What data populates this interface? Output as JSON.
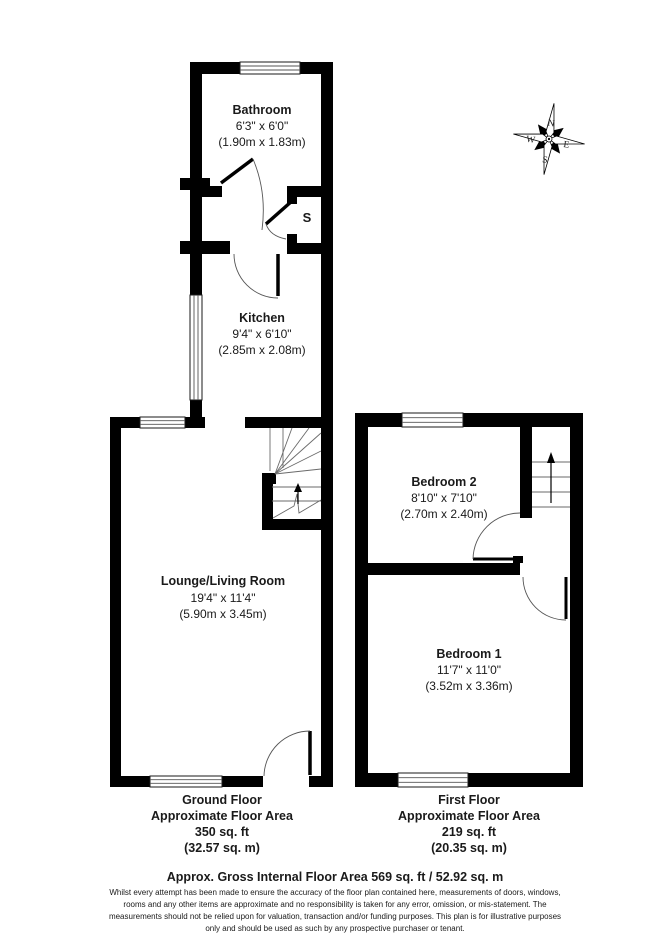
{
  "compass": {
    "n": "N",
    "e": "E",
    "s": "S",
    "w": "W"
  },
  "rooms": {
    "bathroom": {
      "name": "Bathroom",
      "size_imperial": "6'3\" x 6'0\"",
      "size_metric": "(1.90m x 1.83m)"
    },
    "kitchen": {
      "name": "Kitchen",
      "size_imperial": "9'4\" x 6'10\"",
      "size_metric": "(2.85m x 2.08m)"
    },
    "lounge": {
      "name": "Lounge/Living Room",
      "size_imperial": "19'4\" x 11'4\"",
      "size_metric": "(5.90m x 3.45m)"
    },
    "bedroom2": {
      "name": "Bedroom 2",
      "size_imperial": "8'10\" x 7'10\"",
      "size_metric": "(2.70m x 2.40m)"
    },
    "bedroom1": {
      "name": "Bedroom 1",
      "size_imperial": "11'7\" x 11'0\"",
      "size_metric": "(3.52m x 3.36m)"
    },
    "storage": {
      "label": "S"
    }
  },
  "floors": {
    "ground": {
      "name": "Ground Floor",
      "area_label": "Approximate Floor Area",
      "area_ft": "350 sq. ft",
      "area_m": "(32.57 sq. m)"
    },
    "first": {
      "name": "First Floor",
      "area_label": "Approximate Floor Area",
      "area_ft": "219 sq. ft",
      "area_m": "(20.35 sq. m)"
    }
  },
  "summary": {
    "gross_area": "Approx. Gross Internal Floor Area 569 sq. ft / 52.92 sq. m"
  },
  "disclaimer": {
    "lines": [
      "Whilst every attempt has been made to ensure the accuracy of the floor plan contained here, measurements of doors, windows,",
      "rooms and any other items are approximate and no responsibility is taken for any error, omission, or mis-statement. The",
      "measurements should not be relied upon for valuation, transaction and/or funding purposes. This plan is for illustrative purposes",
      "only and should be used as such by any prospective purchaser or tenant."
    ]
  },
  "colors": {
    "wall": "#000000",
    "background": "#ffffff",
    "text": "#1a1a1a"
  }
}
